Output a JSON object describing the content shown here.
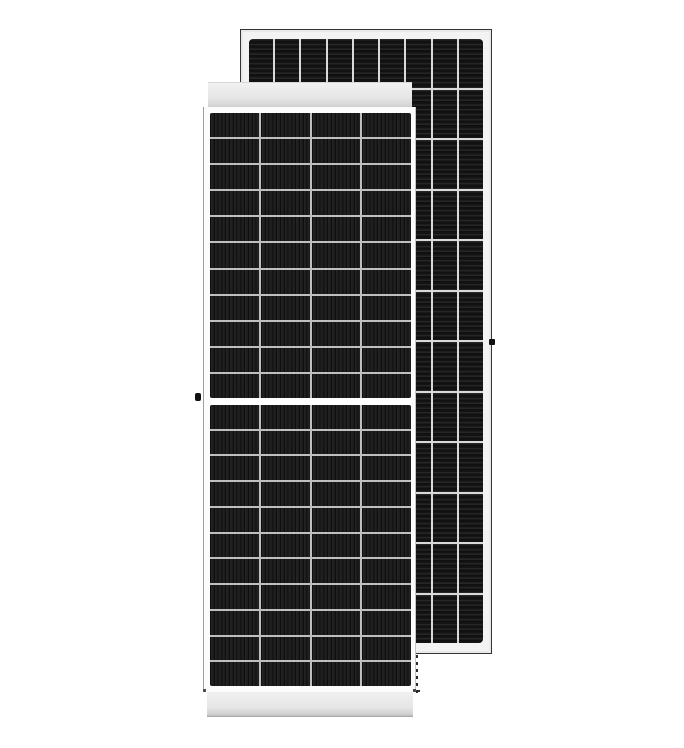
{
  "image": {
    "type": "product-photo",
    "subject": "two framed monocrystalline half-cut solar panel modules, front view overlapping rear view",
    "background": "#ffffff"
  },
  "front_panel": {
    "name": "solar-panel-front-view",
    "frame_color": "#fcfcfc",
    "header_band_color": "#e7e7e7",
    "footer_band_color": "#e6e6e6",
    "grid_line_color": "#bfbfbf",
    "cell_color": "#1b1b1b",
    "cell_stripe_color": "#0e0e0e",
    "grounding_knob_color": "#101010",
    "columns": 4,
    "rows_upper": 11,
    "rows_lower": 11
  },
  "back_panel": {
    "name": "solar-panel-rear-view",
    "frame_color": "#f3f3f3",
    "frame_border_color": "#343434",
    "grid_line_color": "#d9d9d9",
    "cell_color": "#161616",
    "cell_stripe_color": "#262626",
    "grounding_knob_color": "#101010",
    "columns": 9,
    "rows": 12
  }
}
